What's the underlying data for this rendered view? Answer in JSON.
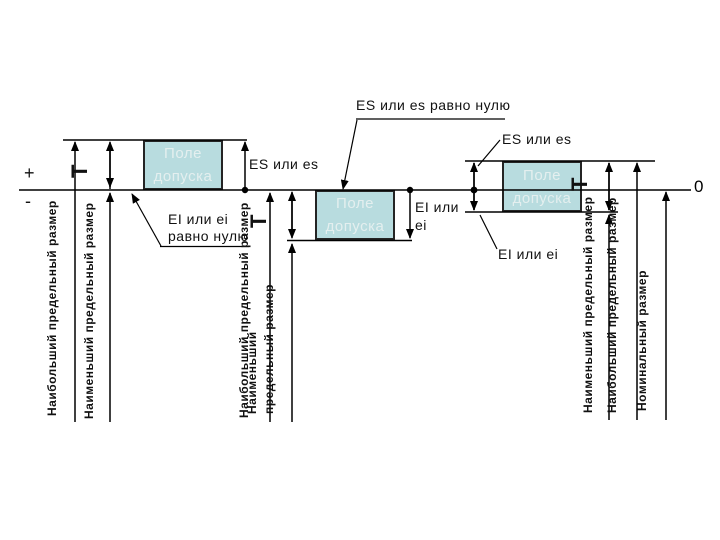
{
  "diagram": {
    "plus": "+",
    "minus": "-",
    "zero": "0",
    "box_label": "Поле допуска",
    "tolerance_symbol": "Т",
    "callout_es_zero": "ES или es равно нулю",
    "callout_ei_zero": "EI или ei равно нулю",
    "label_es": "ES или es",
    "label_ei": "EI или ei",
    "dim_max": "Наибольший предельный размер",
    "dim_min": "Наименьший предельный размер",
    "dim_nominal": "Номинальный размер",
    "colors": {
      "field_fill": "#b8dcdf",
      "field_border": "#242424",
      "field_text": "#e4efef",
      "line": "#000000"
    }
  }
}
